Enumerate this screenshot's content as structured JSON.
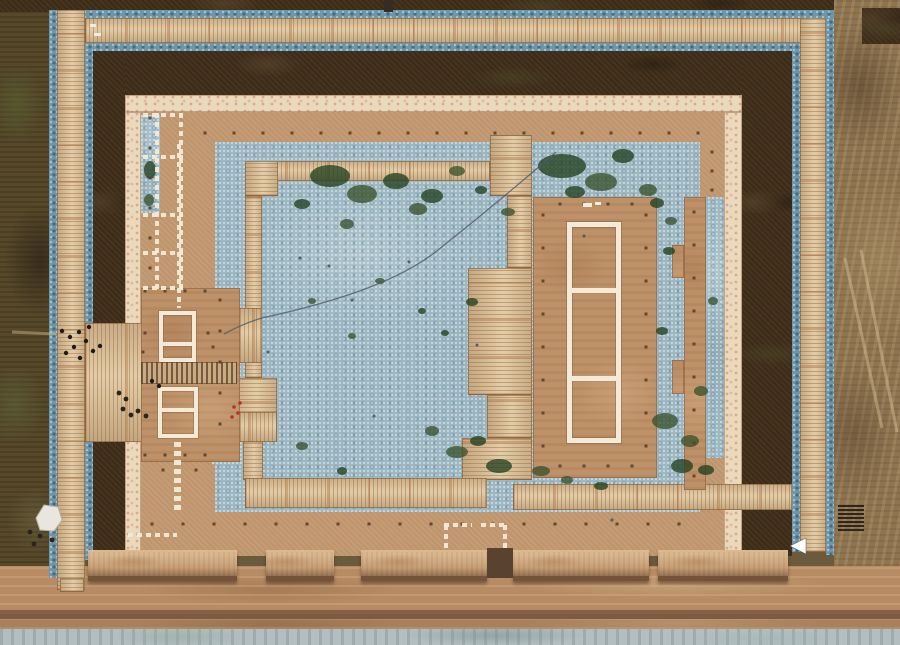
{
  "scene": {
    "type": "aerial-drone-photograph",
    "subject": "top-down view of an excavated ancient palace compound: rectangular enclosure wall, perimeter wooden boardwalks, blue-gravel filled courtyard with moss patches, white-marked building foundation outlines, west gate platforms with visitors, east hall platform, row of rammed-earth wall blocks and a dirt service road along the south side",
    "visible_text": "none"
  },
  "palette": {
    "field-left": "#564829",
    "field-right": "#8f7450",
    "soil-dark": "#47341f",
    "gravel-deep": "#6d96aa",
    "courtyard-blue": "#9db8c3",
    "wood-light": "#dcc49e",
    "wall-cream": "#ead9bd",
    "cream-speckle": "#d8a88a",
    "corridor-tan": "#c69c74",
    "platform-tan": "#bf9168",
    "road": "#b78c64",
    "road-dark": "#7d5c40",
    "pale-strip": "#b2bec0",
    "block-top": "#c79e76",
    "block-shadow": "#75533a",
    "block-hi": "#dcb88d",
    "white-outline": "#f3ebd7",
    "moss-dark": "#22401f",
    "moss-mid": "#3a522c",
    "dot-dark": "#58402a",
    "people-dark": "#1f1b16",
    "red-mark": "#b3352a",
    "crack": "#4d5d68"
  },
  "features": {
    "wall_blocks": [
      [
        88,
        149
      ],
      [
        266,
        68
      ],
      [
        361,
        126
      ],
      [
        513,
        136
      ],
      [
        658,
        130
      ]
    ],
    "dot_rows": [
      {
        "y": 133,
        "x0": 205,
        "x1": 712,
        "step": 29
      },
      {
        "y": 524,
        "x0": 152,
        "x1": 700,
        "step": 31
      },
      {
        "y": 204,
        "x0": 560,
        "x1": 632,
        "step": 24
      },
      {
        "y": 466,
        "x0": 560,
        "x1": 632,
        "step": 24
      },
      {
        "y": 291,
        "x0": 145,
        "x1": 206,
        "step": 20
      },
      {
        "y": 455,
        "x0": 145,
        "x1": 206,
        "step": 20
      }
    ],
    "dot_cols": [
      {
        "x": 150,
        "y0": 118,
        "y1": 288,
        "step": 30
      },
      {
        "x": 220,
        "y0": 300,
        "y1": 452,
        "step": 31
      },
      {
        "x": 543,
        "y0": 215,
        "y1": 460,
        "step": 33
      },
      {
        "x": 646,
        "y0": 215,
        "y1": 460,
        "step": 33
      },
      {
        "x": 694,
        "y0": 212,
        "y1": 478,
        "step": 33
      },
      {
        "x": 712,
        "y0": 152,
        "y1": 190,
        "step": 19
      }
    ],
    "extra_dots": [
      [
        145,
        333
      ],
      [
        143,
        352
      ],
      [
        208,
        333
      ],
      [
        213,
        347
      ],
      [
        163,
        470
      ],
      [
        196,
        470
      ]
    ],
    "dash_lines": [
      [
        157,
        113,
        157,
        290
      ],
      [
        181,
        113,
        181,
        290
      ],
      [
        143,
        115,
        183,
        115
      ],
      [
        143,
        157,
        183,
        157
      ],
      [
        143,
        215,
        183,
        215
      ],
      [
        143,
        253,
        183,
        253
      ],
      [
        143,
        288,
        183,
        288
      ],
      [
        179,
        144,
        179,
        308
      ],
      [
        179,
        442,
        179,
        512
      ],
      [
        176,
        442,
        176,
        512
      ],
      [
        128,
        535,
        177,
        535
      ],
      [
        444,
        525,
        472,
        525
      ],
      [
        446,
        525,
        446,
        550
      ],
      [
        481,
        525,
        508,
        525
      ],
      [
        505,
        525,
        505,
        550
      ]
    ],
    "moss": [
      [
        330,
        176,
        20,
        11
      ],
      [
        362,
        194,
        15,
        9
      ],
      [
        396,
        181,
        13,
        8
      ],
      [
        418,
        209,
        9,
        6
      ],
      [
        302,
        204,
        8,
        5
      ],
      [
        347,
        224,
        7,
        5
      ],
      [
        432,
        196,
        11,
        7
      ],
      [
        457,
        171,
        8,
        5
      ],
      [
        481,
        190,
        6,
        4
      ],
      [
        508,
        212,
        7,
        4
      ],
      [
        562,
        166,
        24,
        12
      ],
      [
        601,
        182,
        16,
        9
      ],
      [
        623,
        156,
        11,
        7
      ],
      [
        648,
        190,
        9,
        6
      ],
      [
        575,
        192,
        10,
        6
      ],
      [
        380,
        281,
        5,
        3
      ],
      [
        422,
        311,
        4,
        3
      ],
      [
        352,
        336,
        4,
        3
      ],
      [
        472,
        302,
        6,
        4
      ],
      [
        312,
        301,
        4,
        3
      ],
      [
        445,
        333,
        4,
        3
      ],
      [
        302,
        446,
        6,
        4
      ],
      [
        342,
        471,
        5,
        4
      ],
      [
        457,
        452,
        11,
        6
      ],
      [
        499,
        466,
        13,
        7
      ],
      [
        432,
        431,
        7,
        5
      ],
      [
        478,
        441,
        8,
        5
      ],
      [
        665,
        421,
        13,
        8
      ],
      [
        682,
        466,
        11,
        7
      ],
      [
        701,
        391,
        7,
        5
      ],
      [
        662,
        331,
        6,
        4
      ],
      [
        713,
        301,
        5,
        4
      ],
      [
        669,
        251,
        6,
        4
      ],
      [
        690,
        441,
        9,
        6
      ],
      [
        706,
        470,
        8,
        5
      ],
      [
        541,
        471,
        9,
        5
      ],
      [
        601,
        486,
        7,
        4
      ],
      [
        567,
        480,
        6,
        4
      ],
      [
        657,
        203,
        7,
        5
      ],
      [
        671,
        221,
        6,
        4
      ],
      [
        150,
        170,
        6,
        9
      ],
      [
        149,
        200,
        5,
        6
      ]
    ],
    "tiny_dots": [
      [
        409,
        262
      ],
      [
        300,
        258
      ],
      [
        352,
        300
      ],
      [
        329,
        266
      ],
      [
        477,
        345
      ],
      [
        374,
        416
      ],
      [
        268,
        352
      ],
      [
        612,
        520
      ],
      [
        584,
        236
      ]
    ],
    "people": [
      [
        62,
        331
      ],
      [
        70,
        337
      ],
      [
        79,
        332
      ],
      [
        86,
        341
      ],
      [
        74,
        347
      ],
      [
        66,
        353
      ],
      [
        93,
        351
      ],
      [
        100,
        346
      ],
      [
        89,
        327
      ],
      [
        80,
        358
      ],
      [
        152,
        381
      ],
      [
        159,
        386
      ]
    ],
    "equipment": [
      [
        119,
        393
      ],
      [
        126,
        399
      ],
      [
        123,
        409
      ],
      [
        131,
        415
      ],
      [
        138,
        411
      ],
      [
        146,
        416
      ],
      [
        30,
        532
      ],
      [
        40,
        536
      ],
      [
        52,
        540
      ],
      [
        34,
        544
      ]
    ],
    "red_marks": [
      [
        234,
        407
      ],
      [
        238,
        413
      ],
      [
        232,
        417
      ],
      [
        240,
        403
      ]
    ],
    "white_bits": [
      [
        583,
        203,
        9,
        4
      ],
      [
        595,
        202,
        6,
        3
      ],
      [
        90,
        24,
        6,
        3
      ],
      [
        94,
        33,
        7,
        3
      ]
    ],
    "crack_path": "M556,152 C515,188 478,218 438,250 C398,282 335,302 262,318 C248,322 235,328 224,334",
    "field_trails": [
      [
        845,
        258,
        882,
        428
      ],
      [
        861,
        250,
        897,
        432
      ],
      [
        12,
        332,
        56,
        334
      ]
    ],
    "stack_slats": {
      "x0": 838,
      "x1": 864,
      "y0": 506,
      "y1": 530,
      "step": 4
    },
    "arrow": "806,538 790,546 806,554",
    "tarp": "36,518 44,505 58,507 62,520 54,531 40,530"
  }
}
